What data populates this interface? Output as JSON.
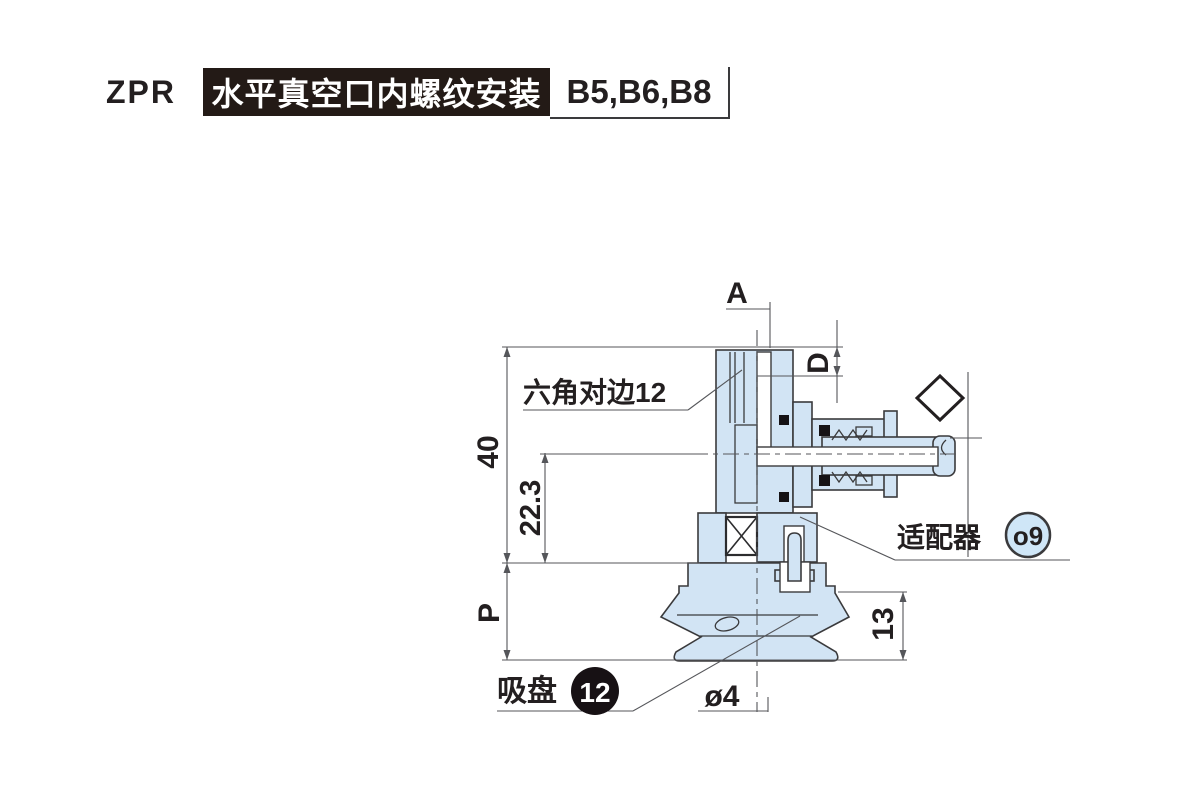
{
  "header": {
    "series": "ZPR",
    "title": "水平真空口内螺纹安装",
    "models": "B5,B6,B8"
  },
  "drawing": {
    "labels": {
      "dim_a": "A",
      "dim_d": "D",
      "dim_40": "40",
      "dim_22_3": "22.3",
      "dim_p": "P",
      "dim_13": "13",
      "dim_dia4": "ø4",
      "hex_note": "六角对边12",
      "adapter_label": "适配器",
      "adapter_badge": "o9",
      "pad_label": "吸盘",
      "pad_badge": "12"
    },
    "colors": {
      "part_fill": "#d2e4f4",
      "outline": "#3a3a3c",
      "dim_line": "#55565a",
      "text": "#231f20",
      "badge_blue_fill": "#cfe6f7",
      "badge_black_fill": "#171114",
      "header_box_bg": "#231a16",
      "header_box_text": "#ffffff"
    }
  }
}
